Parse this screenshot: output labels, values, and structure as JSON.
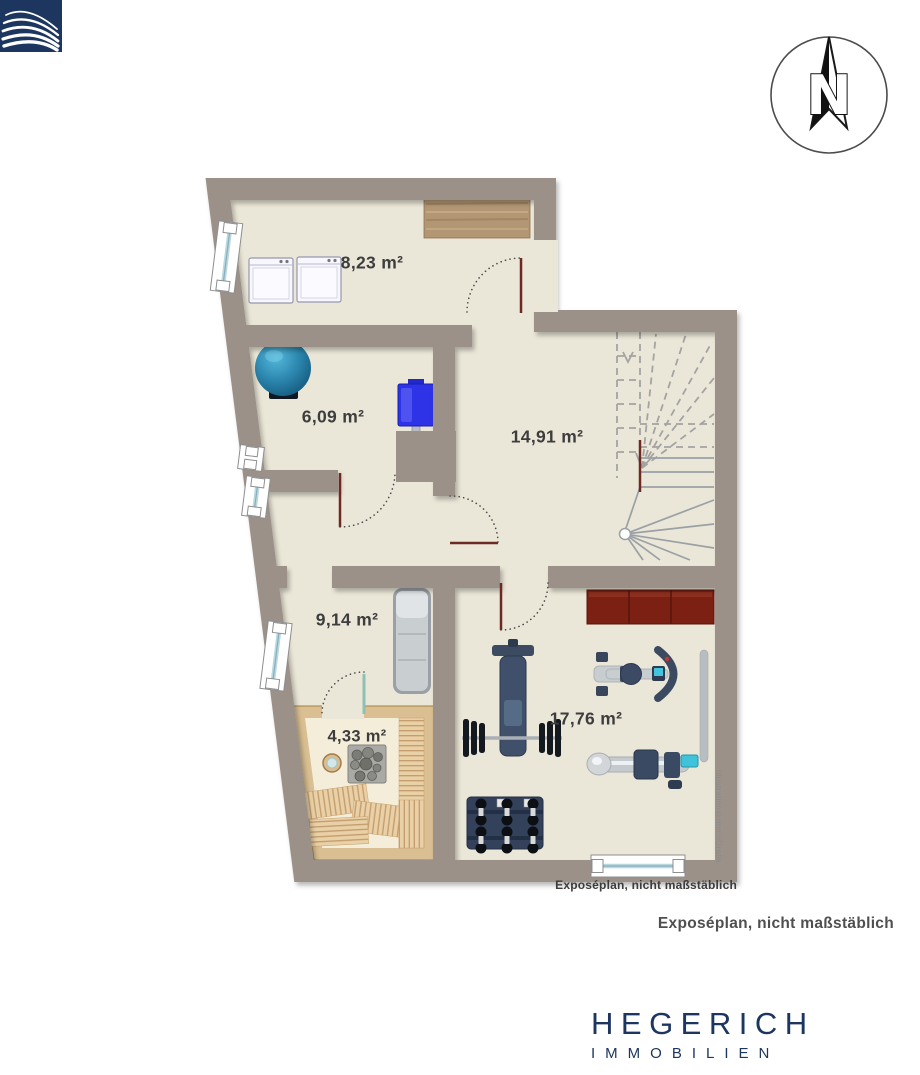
{
  "compass": {
    "label": "N"
  },
  "floor_plan": {
    "rooms": [
      {
        "name": "utility-room",
        "area_label": "8,23 m²"
      },
      {
        "name": "boiler-room",
        "area_label": "6,09 m²"
      },
      {
        "name": "stair-hall",
        "area_label": "14,91 m²"
      },
      {
        "name": "relax-room",
        "area_label": "9,14 m²"
      },
      {
        "name": "sauna",
        "area_label": "4,33 m²"
      },
      {
        "name": "fitness-room",
        "area_label": "17,76 m²"
      }
    ],
    "plan_caption": "Exposéplan, nicht maßstäblich",
    "illustration_credit": "Illustration©immoGrafik"
  },
  "caption": "Exposéplan, nicht maßstäblich",
  "logo": {
    "brand": "HEGERICH",
    "subtitle": "IMMOBILIEN"
  },
  "colors": {
    "wall": "#9b9189",
    "floor": "#ebe7d8",
    "brand_navy": "#1c3660",
    "door_leaf": "#6e2a22",
    "sideboard_red": "#7b2013",
    "sauna_wood": "#d9bf92"
  }
}
